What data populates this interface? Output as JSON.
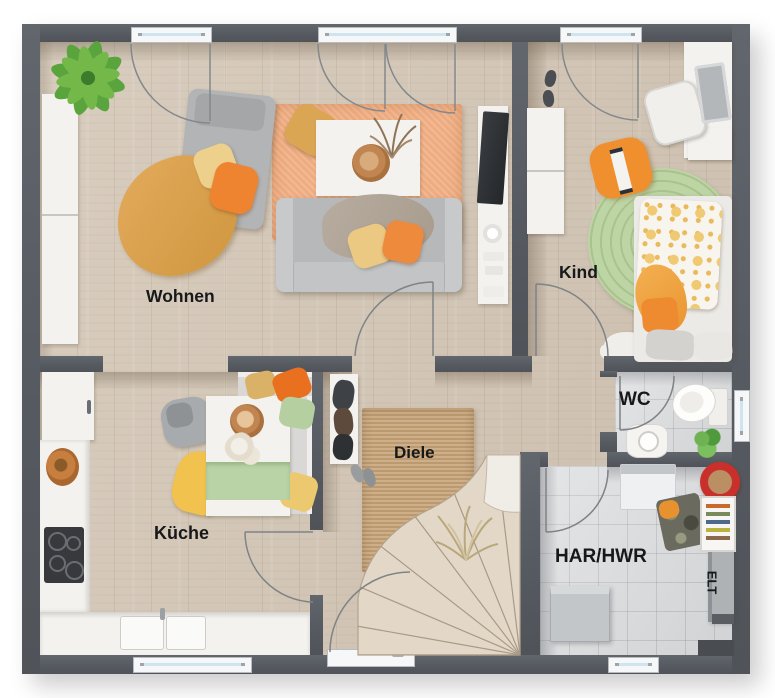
{
  "floorplan": {
    "title": "Erdgeschoss Grundriss",
    "rooms": [
      {
        "id": "wohnen",
        "label": "Wohnen"
      },
      {
        "id": "kind",
        "label": "Kind"
      },
      {
        "id": "kueche",
        "label": "Küche"
      },
      {
        "id": "diele",
        "label": "Diele"
      },
      {
        "id": "wc",
        "label": "WC"
      },
      {
        "id": "har-hwr",
        "label": "HAR/HWR"
      },
      {
        "id": "elt",
        "label": "ELT"
      }
    ],
    "colors": {
      "wall": "#585c63",
      "wood_floor": "#d4c7b7",
      "tile_floor": "#dadcde",
      "rug_orange": "#eeac80",
      "rug_jute": "#c8a67c",
      "rug_green": "#bdd4a4",
      "accent_orange": "#ee8a3c",
      "accent_yellow": "#ecc983",
      "accent_sage": "#b5cfa0",
      "window_glass": "#cfe4ee",
      "bucket_red": "#c9302b"
    }
  }
}
